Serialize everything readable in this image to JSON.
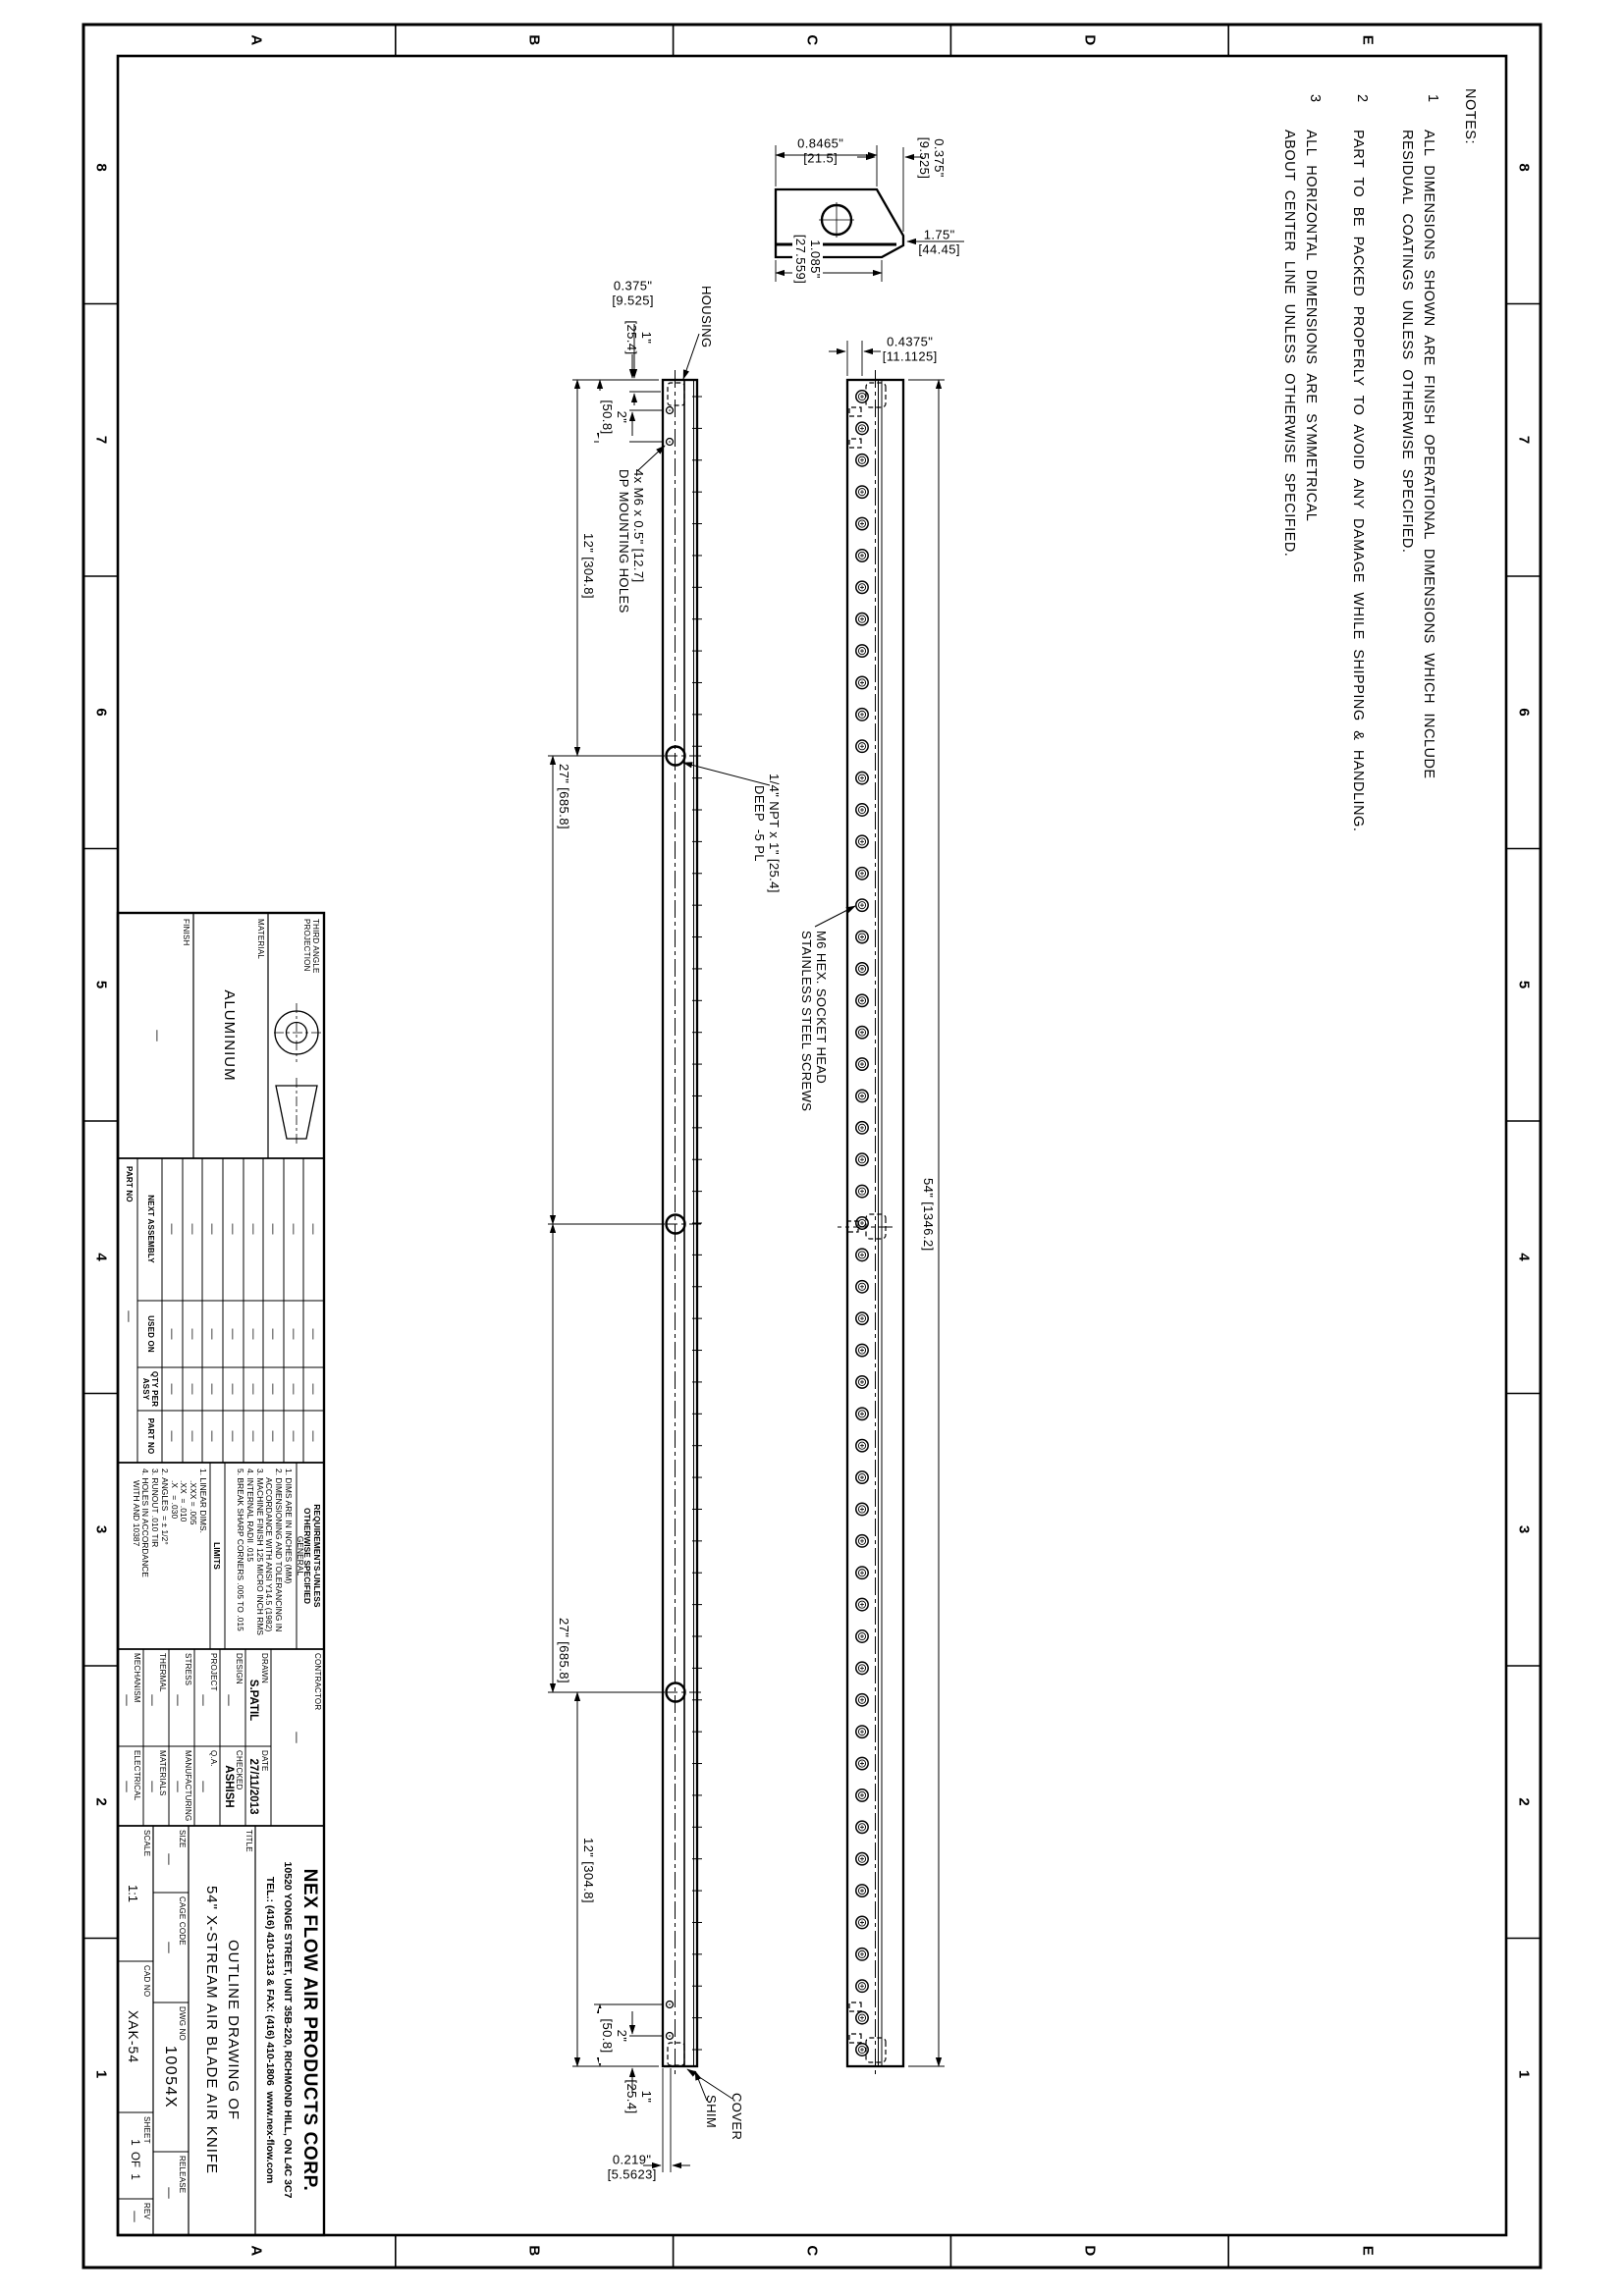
{
  "sheet": {
    "zone_letters": [
      "E",
      "D",
      "C",
      "B",
      "A"
    ],
    "zone_numbers": [
      "8",
      "7",
      "6",
      "5",
      "4",
      "3",
      "2",
      "1"
    ]
  },
  "notes": {
    "heading": "NOTES:",
    "items": [
      {
        "num": "1",
        "text": "ALL DIMENSIONS SHOWN ARE FINISH OPERATIONAL DIMENSIONS WHICH INCLUDE\nRESIDUAL COATINGS UNLESS OTHERWISE SPECIFIED."
      },
      {
        "num": "2",
        "text": "PART TO BE PACKED PROPERLY TO AVOID ANY DAMAGE WHILE SHIPPING & HANDLING."
      },
      {
        "num": "3",
        "text": "ALL HORIZONTAL DIMENSIONS ARE SYMMETRICAL\nABOUT CENTER LINE UNLESS OTHERWISE SPECIFIED."
      }
    ]
  },
  "dims": {
    "d54": "54\" [1346.2]",
    "d27": "27\" [685.8]",
    "d12": "12\" [304.8]",
    "d2": "2\"\n[50.8]",
    "d1": "1\"\n[25.4]",
    "d0375": "0.375\"\n[9.525]",
    "d04375": "0.4375\"\n[11.1125]",
    "d0219": "0.219\"\n[5.5623]",
    "d08465": "0.8465\"\n[21.5]",
    "d1085": "1.085\"\n[27.559]",
    "d175": "1.75\"\n[44.45]"
  },
  "callouts": {
    "housing": "HOUSING",
    "cover": "COVER",
    "shim": "SHIM",
    "screws": "M6 HEX. SOCKET HEAD\nSTAINLESS STEEL SCREWS",
    "npt": "1/4\" NPT x 1\" [25.4]\n   DEEP  -5 PL",
    "mounting": "4x M6 x 0.5\" [12.7]\nDP MOUNTING HOLES"
  },
  "views": {
    "screw_count": 53,
    "port_count": 3,
    "mounting_hole_count": 4
  },
  "title_block": {
    "projection": {
      "label": "THIRD ANGLE\nPROJECTION"
    },
    "material": {
      "label": "MATERIAL",
      "value": "ALUMINIUM"
    },
    "finish": {
      "label": "FINISH",
      "value": "—"
    },
    "application": {
      "headers": [
        "NEXT ASSEMBLY",
        "USED ON",
        "QTY PER\nASSY",
        "PART NO"
      ],
      "row_label": "PART NO",
      "empty": "—",
      "rows": 8
    },
    "requirements": {
      "heading": "REQUIREMENTS-UNLESS\nOTHERWISE SPECIFIED",
      "general_heading": "GENERAL",
      "general": [
        "1. DIMS ARE IN INCHES (MM)",
        "2. DIMENSIONING AND TOLERANCING IN\n    ACCORDANCE WITH ANSI Y14.5 (1982)",
        "3. MACHINE FINISH 125 MICRO INCH RMS",
        "4. INTERNAL RADII .015",
        "5. BREAK SHARP CORNERS .005 TO .015"
      ],
      "limits_heading": "LIMITS",
      "limits": [
        "1. LINEAR DIMS.",
        "     .XXX = .005",
        "     .XX  = .010",
        "     .X   = .030",
        "2. ANGLES  = ± 1/2°",
        "3. RUNOUT .010 TIR",
        "4. HOLES IN ACCORDANCE\n     WITH AND 10387"
      ]
    },
    "signoff": {
      "contractor_label": "CONTRACTOR",
      "contractor": "—",
      "drawn_label": "DRAWN",
      "drawn": "S.PATIL",
      "date_label": "DATE",
      "date": "27/11/2013",
      "design_label": "DESIGN",
      "design": "—",
      "checked_label": "CHECKED",
      "checked": "ASHISH",
      "project_label": "PROJECT",
      "project": "—",
      "qa_label": "Q.A.",
      "qa": "—",
      "stress_label": "STRESS",
      "stress": "—",
      "manufacturing_label": "MANUFACTURING",
      "manufacturing": "—",
      "thermal_label": "THERMAL",
      "thermal": "—",
      "materials_label": "MATERIALS",
      "materials": "—",
      "mechanism_label": "MECHANISM",
      "mechanism": "—",
      "electrical_label": "ELECTRICAL",
      "electrical": "—"
    },
    "company": {
      "name": "NEX FLOW AIR PRODUCTS CORP.",
      "address": "10520 YONGE STREET, UNIT 35B-220, RICHMOND HILL, ON L4C 3C7",
      "contact": "TEL.: (416) 410-1313 & FAX: (416) 410-1806  www.nex-flow.com"
    },
    "title": {
      "label": "TITLE",
      "line1": "OUTLINE DRAWING OF",
      "line2": "54\" X-STREAM AIR BLADE AIR KNIFE"
    },
    "info": {
      "size_label": "SIZE",
      "size": "—",
      "cage_label": "CAGE CODE",
      "cage": "—",
      "dwg_label": "DWG NO",
      "dwg": "10054X",
      "release_label": "RELEASE",
      "release": "—",
      "scale_label": "SCALE",
      "scale": "1:1",
      "cad_label": "CAD NO",
      "cad": "XAK-54",
      "sheet_label": "SHEET",
      "sheet": "1  OF  1",
      "rev_label": "REV",
      "rev": "—"
    }
  }
}
